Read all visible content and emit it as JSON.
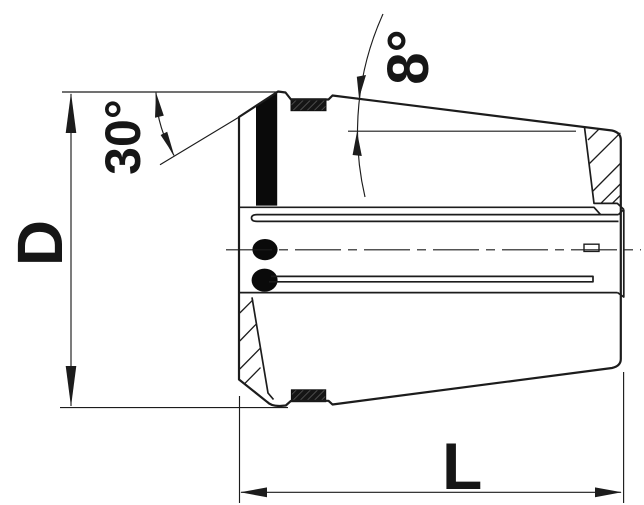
{
  "drawing": {
    "labels": {
      "diameter": "D",
      "chamfer_angle": "30°",
      "taper_angle": "8°",
      "length": "L"
    },
    "colors": {
      "background": "#ffffff",
      "line": "#1c1c1c",
      "solid_fill": "#0a0a0a"
    }
  }
}
